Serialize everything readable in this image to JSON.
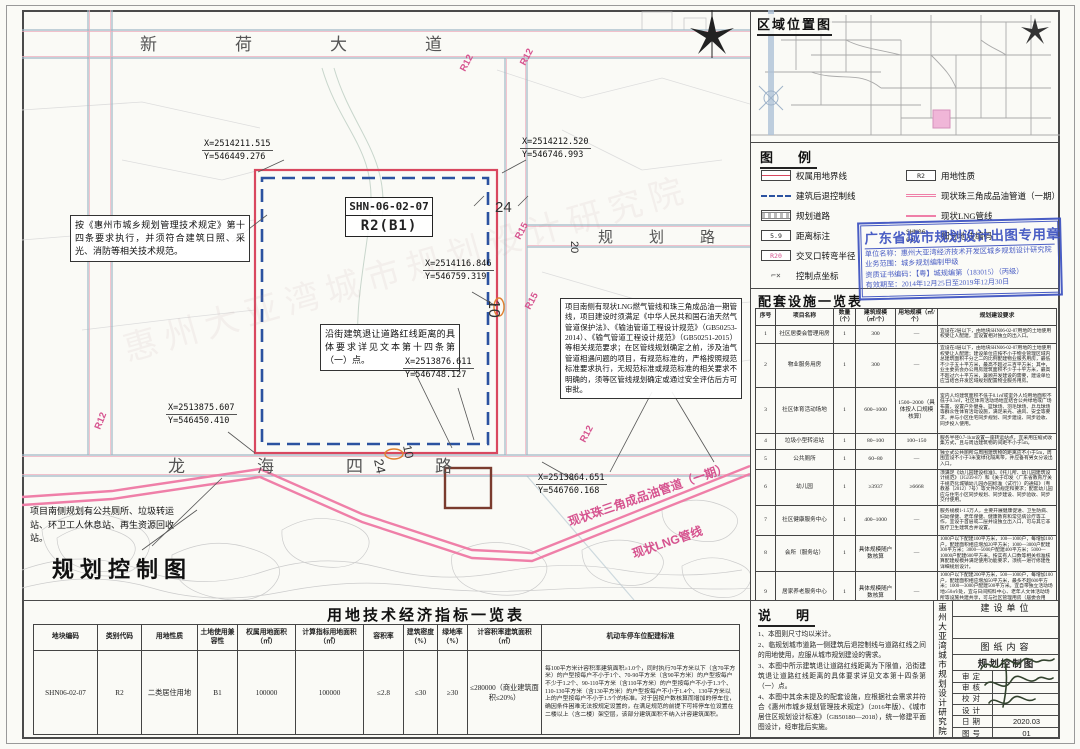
{
  "map": {
    "title": "规划控制图",
    "roads": {
      "north": "新荷大道",
      "east": "规划路",
      "south": "龙海四路"
    },
    "r_labels": [
      "R12",
      "R12",
      "R15",
      "R15",
      "R12",
      "R12"
    ],
    "dimensions": [
      "24",
      "20",
      "10",
      "10",
      "24"
    ],
    "parcel": {
      "code": "SHN-06-02-07",
      "zoning": "R2(B1)"
    },
    "coords": [
      {
        "x": "X=2514211.515",
        "y": "Y=546449.276"
      },
      {
        "x": "X=2514212.520",
        "y": "Y=546746.993"
      },
      {
        "x": "X=2514116.846",
        "y": "Y=546759.319"
      },
      {
        "x": "X=2513875.607",
        "y": "Y=546450.410"
      },
      {
        "x": "X=2513876.611",
        "y": "Y=546748.127"
      },
      {
        "x": "X=2513864.651",
        "y": "Y=546760.168"
      }
    ],
    "pipelines": {
      "oil": "现状珠三角成品油管道（一期）",
      "lng": "现状LNG管线"
    },
    "annotations": [
      "按《惠州市城乡规划管理技术规定》第十四条要求执行，并须符合建筑日照、采光、消防等相关技术规范。",
      "沿街建筑退让道路红线距离的具体要求详见文本第十四条第（一）点。",
      "项目南侧有现状LNG燃气管线和珠三角成品油一期管线，项目建设时须满足《中华人民共和国石油天然气管道保护法》、《输油管道工程设计规范》（GB50253-2014）、《输气管道工程设计规范》（GB50251-2015）等相关规范要求；在区管线规划确定之前，涉及油气管道相遇问题的项目，有规范标准的，严格按照规范标准要求执行，无规范标准或规范标准的相关要求不明确的，须等区管线规划确定或通过安全评估后方可审批。",
      "项目南侧规划有公共厕所、垃圾转运站、环卫工人休息站、再生资源回收站。"
    ]
  },
  "location_map": {
    "title": "区域位置图"
  },
  "legend": {
    "title": "图　例",
    "left": [
      {
        "icon": "boundary-line-icon",
        "label": "权属用地界线"
      },
      {
        "icon": "setback-line-icon",
        "label": "建筑后退控制线"
      },
      {
        "icon": "planned-road-icon",
        "label": "规划道路"
      },
      {
        "icon": "distance-icon",
        "label": "距离标注",
        "sample": "5.9"
      },
      {
        "icon": "radius-icon",
        "label": "交叉口转弯半径",
        "sample": "R20"
      },
      {
        "icon": "control-point-icon",
        "label": "控制点坐标",
        "sample": "⌐×"
      }
    ],
    "right": [
      {
        "icon": "landuse-icon",
        "label": "用地性质",
        "sample": "R2"
      },
      {
        "icon": "oil-pipeline-icon",
        "label": "现状珠三角成品油管道（一期）"
      },
      {
        "icon": "lng-pipeline-icon",
        "label": "现状LNG管线"
      },
      {
        "icon": "subplot-code-icon",
        "label": "细分地块编码",
        "sample": "SHN06-02"
      }
    ]
  },
  "stamp": {
    "title": "广东省城市规划设计出图专用章",
    "lines": [
      "单位名称：惠州大亚湾经济技术开发区城乡规划设计研究院",
      "业务范围：城乡规划编制甲级",
      "资质证书编码：【粤】城规编第（183015）（丙级）",
      "有效期至：2014年12月25日至2019年12月30日"
    ]
  },
  "facilities": {
    "title": "配套设施一览表",
    "columns": [
      "序号",
      "项目名称",
      "数量（个）",
      "建筑规模（㎡/个）",
      "用地规模（㎡/个）",
      "规划建设要求"
    ],
    "rows": [
      {
        "no": "1",
        "name": "社区居委会管理用房",
        "qty": "1",
        "floor": "300",
        "land": "—",
        "req": "宜设在2层以下，由地块SHN06-02-07用地的土地使用权受让人配建，宜设置相对独立的出入口。"
      },
      {
        "no": "2",
        "name": "物业服务用房",
        "qty": "1",
        "floor": "300",
        "land": "—",
        "req": "宜设在4层以下，由地块SHN06-02-07用地的土地使用权受让人配建；建设单位应按不小于物业管理区域内总建筑面积千分之二的比例配建物业服务用房，最低不少于五十平方米，最高不超过三百平方米；其中，业主委员会办公用房建筑面积不少于十平方米，最高不超过六十平方米，兼顾开发建设的需要，建设单位应当结合开发区域规划配置物业服务用房。"
      },
      {
        "no": "3",
        "name": "社区体育活动场地",
        "qty": "1",
        "floor": "600~1000",
        "land": "1500~2000（具体按人口规模核算）",
        "req": "室内人均建筑面积不低于0.1㎡或室外人均用地面积不低于0.3㎡，社区体育活动场地宜结合公共绿地或广场布置，设置户外健身、篮球场、羽毛球场、乒乓球场等群众性体育活动设施，满足采光、通风、安全等要求，并与小区住宅同步规划、同步建设、同步验收、同步投入使用。"
      },
      {
        "no": "4",
        "name": "垃圾小型转运站",
        "qty": "1",
        "floor": "80~100",
        "land": "100~150",
        "req": "服务半径0.7-1km设置一座转运站点，宜采用压缩式收集方式，且与周边建筑物的间距不小于5m。"
      },
      {
        "no": "5",
        "name": "公共厕所",
        "qty": "1",
        "floor": "60~80",
        "land": "—",
        "req": "独立式公共厕所与周围建筑物的距离应不小于5m，周围宜设不小于3米宽绿化隔离带，并应备有男女分设出入口。"
      },
      {
        "no": "6",
        "name": "幼儿园",
        "qty": "1",
        "floor": "≥3937",
        "land": "≥6668",
        "req": "须满足《幼儿园建设标准》、《托儿所、幼儿园建筑设计规范》（JGJ39-87）和《关于印发〈广东省教育厅关于规范化城镇幼儿园办园标准（试行）〉的通知》（粤教基〔2012〕7号）等文件的规定和要求；配套幼儿园应与住宅小区同步规划、同步建设、同步验收、同步交付使用。"
      },
      {
        "no": "7",
        "name": "社区健康服务中心",
        "qty": "1",
        "floor": "400~1000",
        "land": "—",
        "req": "服务规模1-1.5万人，主要开展健康促进、卫生防病、妇幼保健、老年保健、健康教育和常见病诊疗等工作，宜设于首层或二层并设独立出入口，可与其它非医疗卫生建筑合并设置。"
      },
      {
        "no": "8",
        "name": "会所（服务站）",
        "qty": "1",
        "floor": "具体规模随户数核算",
        "land": "—",
        "req": "1000户以下配建100平方米，100—1000户，每增加100户，配建面积相应增加20平方米；1000—3000户配建300平方米；3000—5000户配建400平方米；5000—10000户配建600平方米。按实有人口数等相关标准核算配建规模并满足使用功能要求，须统一进行修建性详细规划设计。"
      },
      {
        "no": "9",
        "name": "居家养老服务中心",
        "qty": "1",
        "floor": "具体规模随户数核算",
        "land": "—",
        "req": "1000户以下配建200平方米，500—1000户，每增加100户，配建面积相应增加50平方米，最多不超600平方米；1000—3000户配建500平方米。宜自带独立活动场地≥50㎡/处，宜与日间照料中心、老年人文体活动场所等设施共建共享，可与社区管理用房（居委会用房、社区警务、便民服务、居家养老服务工作、社区居民活动服务中心、图书阅览室）合并设置。"
      }
    ]
  },
  "indicators": {
    "title": "用地技术经济指标一览表",
    "columns": [
      "地块编码",
      "类别代码",
      "用地性质",
      "土地使用兼容性",
      "权属用地面积（㎡）",
      "计算指标用地面积（㎡）",
      "容积率",
      "建筑密度（%）",
      "绿地率（%）",
      "计容积率建筑面积（㎡）",
      "机动车停车位配建标准"
    ],
    "row": [
      "SHN06-02-07",
      "R2",
      "二类居住用地",
      "B1",
      "100000",
      "100000",
      "≤2.8",
      "≤30",
      "≥30",
      "≤280000（商业建筑面积≤20%）",
      "每100平方米计容积率建筑面积≥1.0个，同时执行70平方米以下（含70平方米）的户型按每户不小于1个、70-90平方米（含90平方米）的户型按每户不少于1.2个、90-110平方米（含110平方米）的户型按每户不小于1.3个、110-130平方米（含130平方米）的户型按每户不小于1.4个、130平方米以上的户型按每户不小于1.5个的标准。对于因按户数核算而增加的停车位，确因条件困难无法按规定设置的，在满足规范的前提下可将停车位设置在二楼以上（含二楼）架空层，该部分建筑面积不纳入计容建筑面积。"
    ]
  },
  "notes": {
    "title": "说　明",
    "items": [
      "1、本图则尺寸均以米计。",
      "2、临规划城市道路一侧建筑后退控制线与道路红线之间的用地使用，应服从城市规划建设的需求。",
      "3、本图中所示建筑退让道路红线距离为下限值，沿街建筑退让道路红线距离的具体要求详见文本第十四条第（一）点。",
      "4、本图中其余未提及的配套设施，应根据社会需求并符合《惠州市城乡规划管理技术规定》（2016年版）、《城市居住区规划设计标准》（GB50180—2018），统一修建平面图设计，经审批后实施。"
    ]
  },
  "titleblock": {
    "institute": "惠州大亚湾城市规划设计研究院",
    "owner_label": "建设单位",
    "content_label": "图纸内容",
    "drawing_name": "规划控制图",
    "rows": [
      {
        "label": "审定",
        "value": ""
      },
      {
        "label": "审核",
        "value": ""
      },
      {
        "label": "校对",
        "value": ""
      },
      {
        "label": "设计",
        "value": ""
      },
      {
        "label": "日期",
        "value": "2020.03"
      },
      {
        "label": "图号",
        "value": "01"
      }
    ]
  },
  "colors": {
    "boundary_red": "#d9475f",
    "setback_blue": "#2b52a0",
    "pipeline_pink": "#ef7fa8",
    "stamp_blue": "#3b50c0",
    "parcel_pink": "#f0b6d8"
  }
}
